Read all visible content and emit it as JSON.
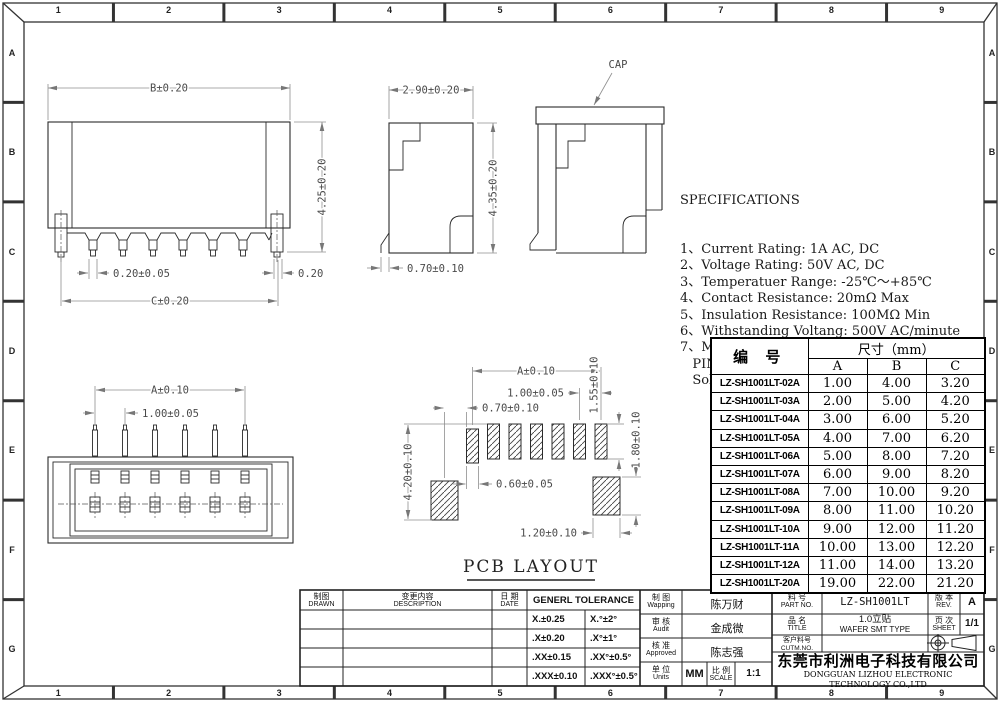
{
  "border": {
    "cols": [
      "1",
      "2",
      "3",
      "4",
      "5",
      "6",
      "7",
      "8",
      "9"
    ],
    "rows": [
      "A",
      "B",
      "C",
      "D",
      "E",
      "F",
      "G"
    ]
  },
  "views": {
    "front": {
      "width": "B±0.20",
      "height": "4.25±0.20",
      "pin_width": "0.20±0.05",
      "tab_width": "0.20",
      "span": "C±0.20"
    },
    "side": {
      "width": "2.90±0.20",
      "height": "4.35±0.20",
      "foot": "0.70±0.10"
    },
    "cap": {
      "label": "CAP"
    },
    "top": {
      "span": "A±0.10",
      "pitch": "1.00±0.05"
    },
    "pcb": {
      "title": "PCB LAYOUT",
      "span": "A±0.10",
      "pitch": "1.00±0.05",
      "offset": "0.70±0.10",
      "pad_width": "0.60±0.05",
      "pad_height": "1.55±0.10",
      "tab_pad_width": "1.20±0.10",
      "tab_pad_height": "1.80±0.10",
      "total_height": "4.20±0.10"
    }
  },
  "specifications": {
    "title": "SPECIFICATIONS",
    "items": [
      "1、Current Rating: 1A AC, DC",
      "2、Voltage Rating: 50V AC, DC",
      "3、Temperatuer Range: -25℃～+85℃",
      "4、Contact Resistance: 20mΩ Max",
      "5、Insulation Resistance: 100MΩ Min",
      "6、Withstanding Voltang: 500V AC/minute",
      "7、Material:Wafer LCP,UL94V-0",
      "   PIN Phosphoric bronze Tin-plated",
      "   Solder tad Phosphoric bronze Tin-plated"
    ]
  },
  "table": {
    "col_part": "编  号",
    "col_size": "尺寸（mm）",
    "sub_cols": [
      "A",
      "B",
      "C"
    ],
    "rows": [
      [
        "LZ-SH1001LT-02A",
        "1.00",
        "4.00",
        "3.20"
      ],
      [
        "LZ-SH1001LT-03A",
        "2.00",
        "5.00",
        "4.20"
      ],
      [
        "LZ-SH1001LT-04A",
        "3.00",
        "6.00",
        "5.20"
      ],
      [
        "LZ-SH1001LT-05A",
        "4.00",
        "7.00",
        "6.20"
      ],
      [
        "LZ-SH1001LT-06A",
        "5.00",
        "8.00",
        "7.20"
      ],
      [
        "LZ-SH1001LT-07A",
        "6.00",
        "9.00",
        "8.20"
      ],
      [
        "LZ-SH1001LT-08A",
        "7.00",
        "10.00",
        "9.20"
      ],
      [
        "LZ-SH1001LT-09A",
        "8.00",
        "11.00",
        "10.20"
      ],
      [
        "LZ-SH1001LT-10A",
        "9.00",
        "12.00",
        "11.20"
      ],
      [
        "LZ-SH1001LT-11A",
        "10.00",
        "13.00",
        "12.20"
      ],
      [
        "LZ-SH1001LT-12A",
        "11.00",
        "14.00",
        "13.20"
      ],
      [
        "LZ-SH1001LT-20A",
        "19.00",
        "22.00",
        "21.20"
      ]
    ]
  },
  "titleblock": {
    "drawn_cn": "制图",
    "drawn_en": "DRAWN",
    "desc_cn": "变更内容",
    "desc_en": "DESCRIPTION",
    "date_cn": "日 期",
    "date_en": "DATE",
    "tol_title": "GENERL TOLERANCE",
    "tolerances": [
      [
        "X.±0.25",
        "X.°±2°"
      ],
      [
        ".X±0.20",
        ".X°±1°"
      ],
      [
        ".XX±0.15",
        ".XX°±0.5°"
      ],
      [
        ".XXX±0.10",
        ".XXX°±0.5°"
      ]
    ],
    "wapping_cn": "制 图",
    "wapping_en": "Wapping",
    "wapping_val": "陈万财",
    "audit_cn": "审 核",
    "audit_en": "Audit",
    "audit_val": "金成微",
    "approved_cn": "核 准",
    "approved_en": "Approved",
    "approved_val": "陈志强",
    "units_cn": "单 位",
    "units_en": "Units",
    "units_val": "MM",
    "scale_cn": "比 例",
    "scale_en": "SCALE",
    "scale_val": "1:1",
    "part_cn": "料 号",
    "part_en": "PART NO.",
    "part_val": "LZ-SH1001LT",
    "rev_cn": "版 本",
    "rev_en": "REV.",
    "rev_val": "A",
    "title_cn": "品 名",
    "title_en": "TITLE",
    "product_cn": "1.0立贴",
    "product_en": "WAFER SMT TYPE",
    "sheet_cn": "页 次",
    "sheet_en": "SHEET",
    "sheet_val": "1/1",
    "cutm_cn": "客户料号",
    "cutm_en": "CUTM.NO.",
    "company_cn": "东莞市利洲电子科技有限公司",
    "company_en": "DONGGUAN LIZHOU ELECTRONIC TECHNOLOGY CO.,LTD"
  }
}
